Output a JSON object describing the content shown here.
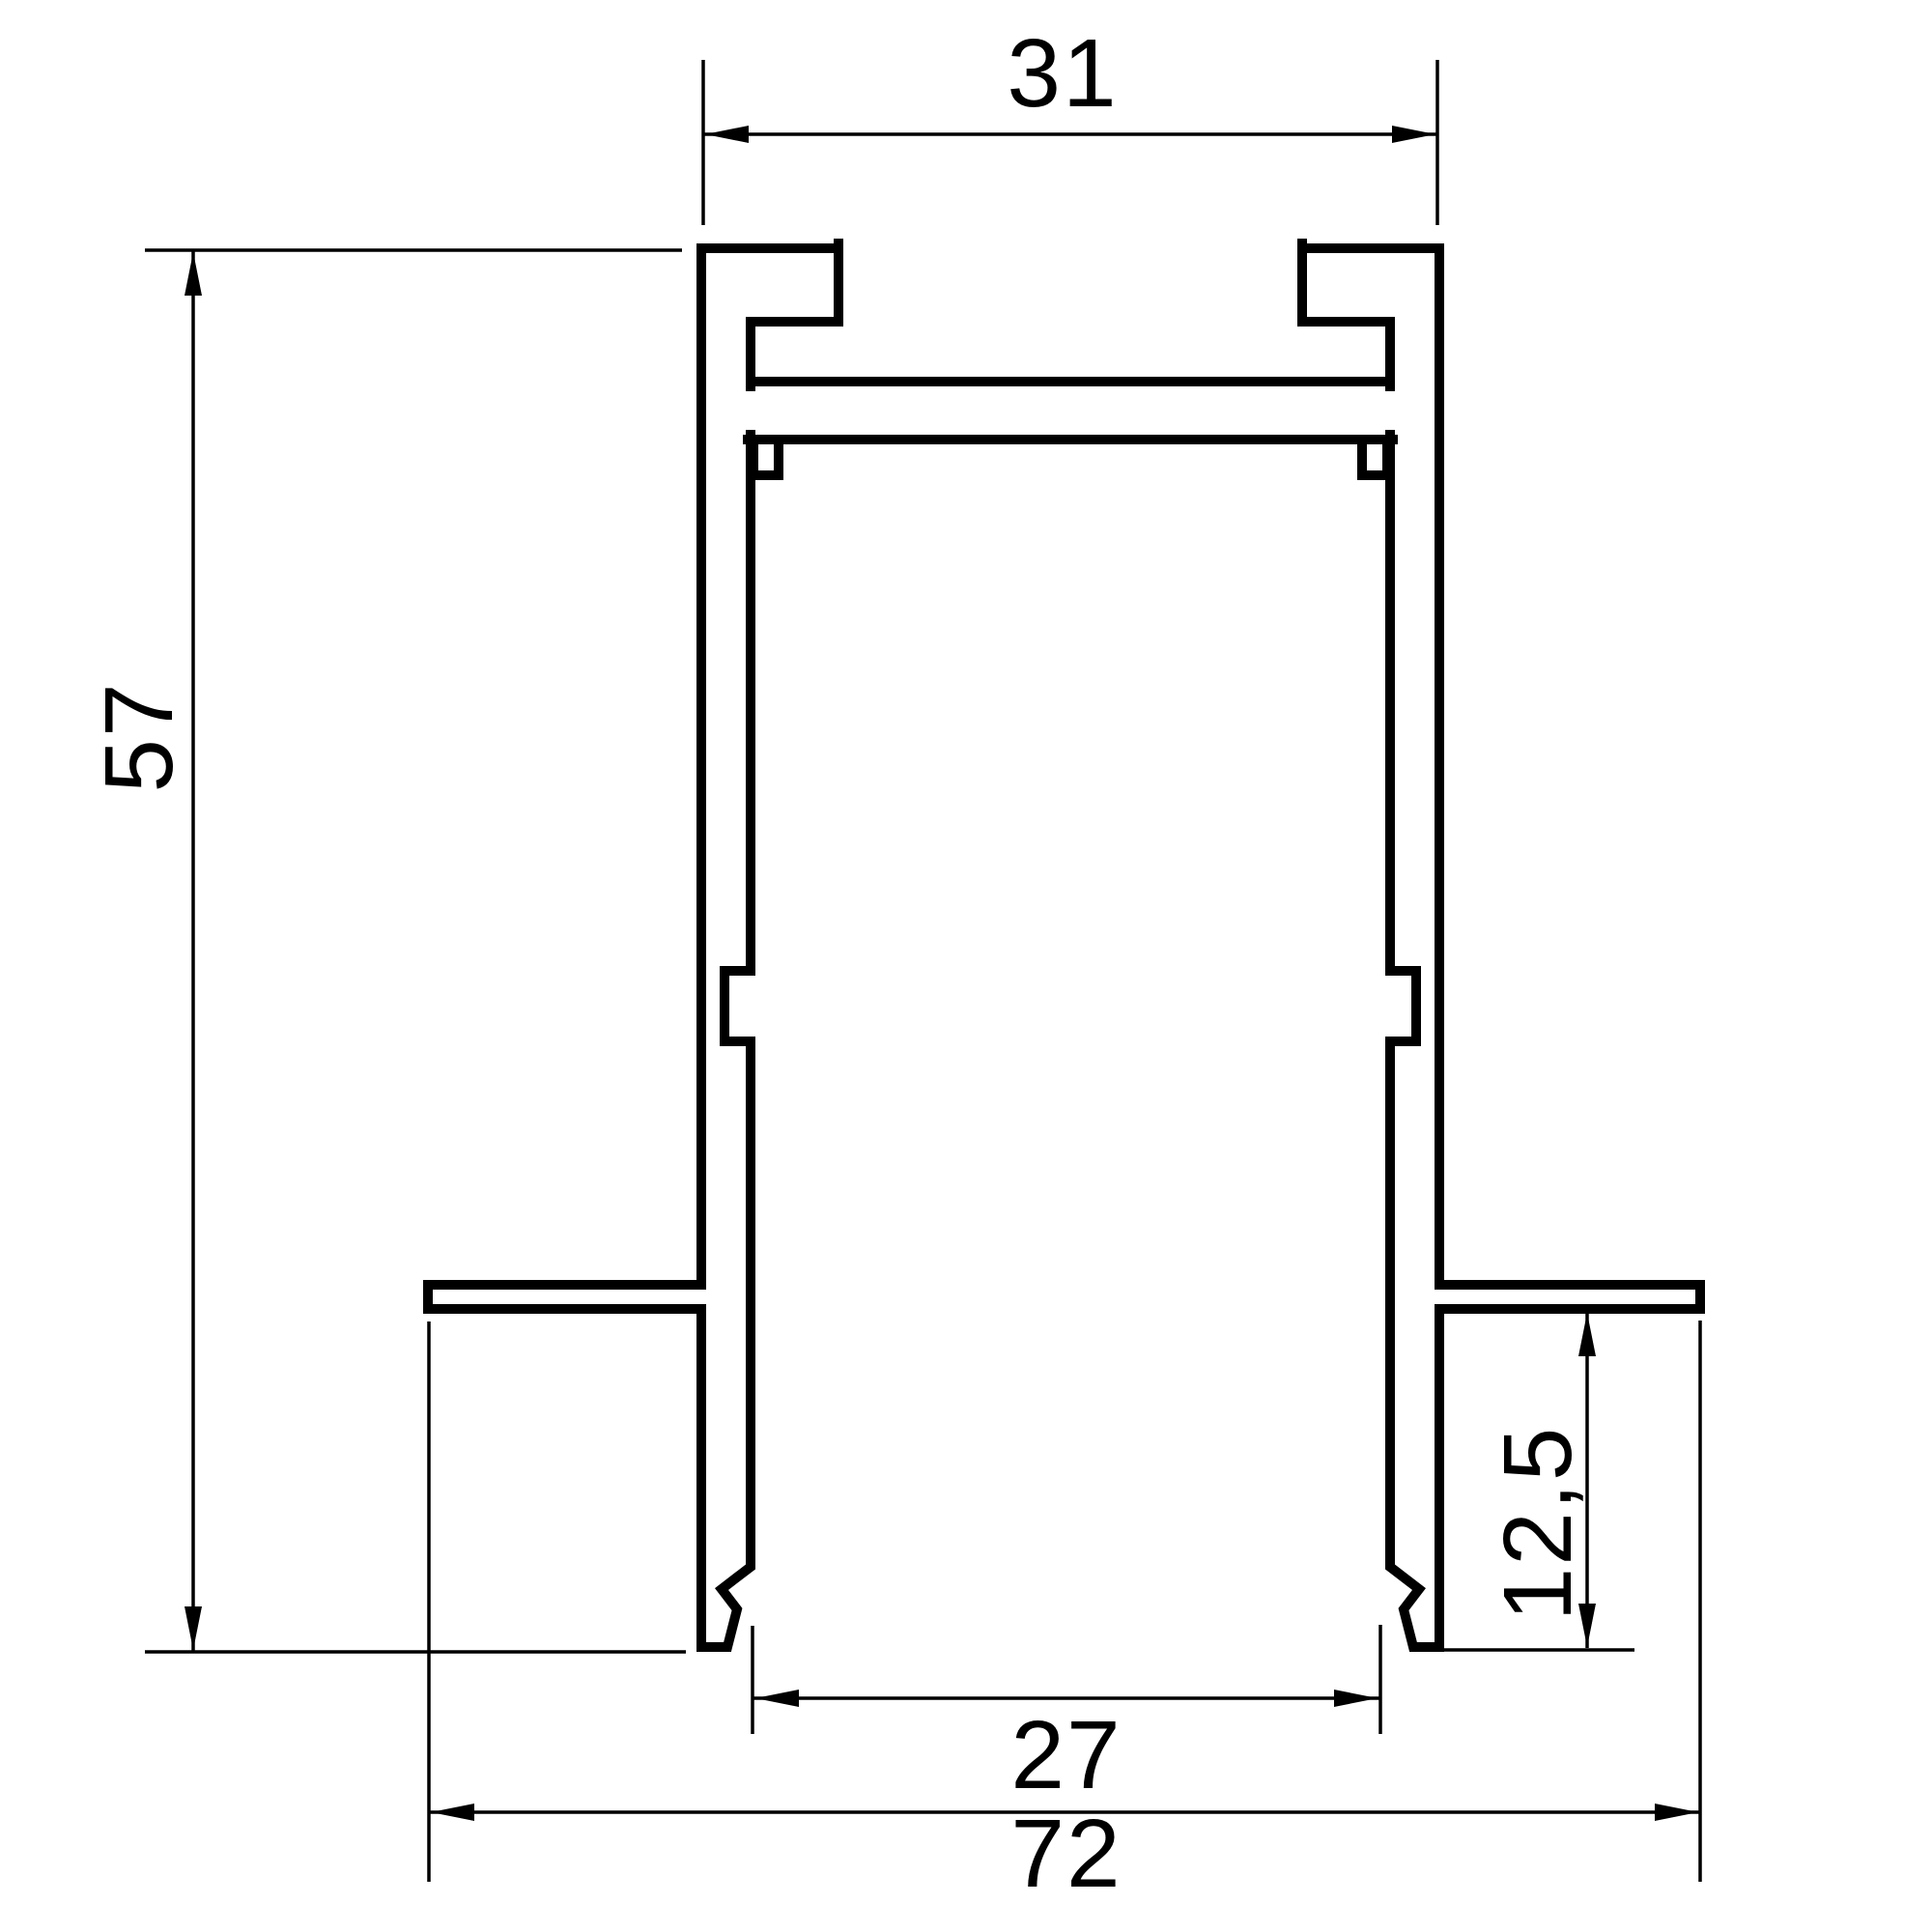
{
  "drawing": {
    "kind": "technical cross-section drawing of an extruded recessed track profile",
    "background_color": "#ffffff",
    "line_color": "#000000"
  },
  "dimensions": {
    "top_width": {
      "label": "31",
      "position": "top"
    },
    "overall_height": {
      "label": "57",
      "position": "left",
      "orientation": "rotated"
    },
    "inner_bottom_width": {
      "label": "27",
      "position": "bottom-inner"
    },
    "overall_width": {
      "label": "72",
      "position": "bottom-outer"
    },
    "recess_depth": {
      "label": "12,5",
      "position": "right",
      "orientation": "rotated"
    }
  }
}
